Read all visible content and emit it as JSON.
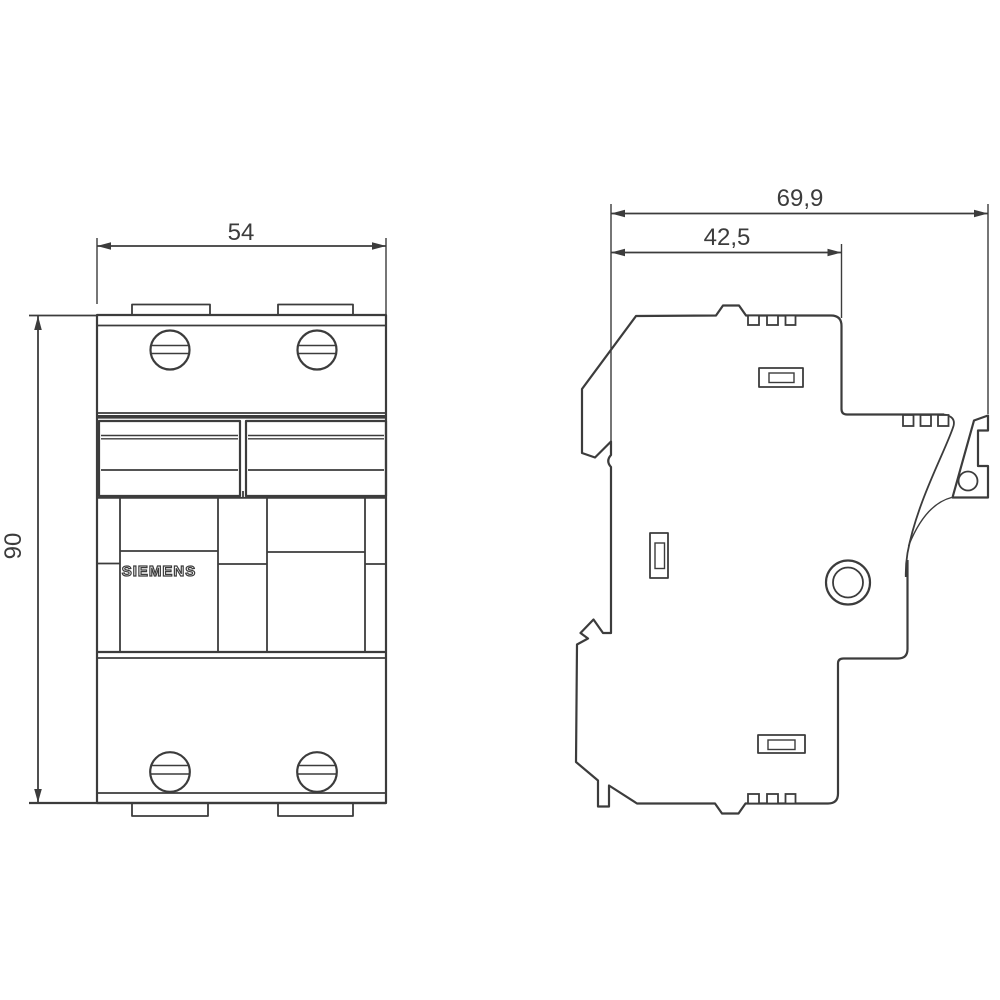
{
  "drawing": {
    "brand": "SIEMENS",
    "dims": {
      "front_width": "54",
      "front_height": "90",
      "side_depth_total": "69,9",
      "side_depth_rail": "42,5"
    },
    "colors": {
      "line": "#3c3c3c",
      "background": "#ffffff"
    }
  }
}
